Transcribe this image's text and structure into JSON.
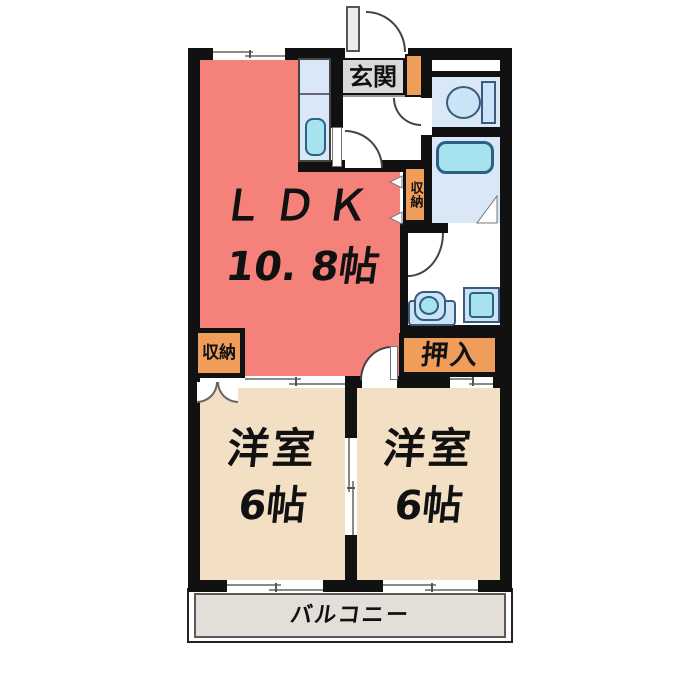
{
  "plan": {
    "ldk": {
      "label": "ＬＤＫ",
      "size": "10. 8帖"
    },
    "bedroom_left": {
      "label": "洋室",
      "size": "6帖"
    },
    "bedroom_right": {
      "label": "洋室",
      "size": "6帖"
    },
    "entrance_label": "玄関",
    "hall_storage_label": "収納",
    "ldk_storage_label": "収納",
    "oshiire_label": "押入",
    "balcony_label": "バルコニー"
  },
  "colors": {
    "ldk_fill": "#F5827A",
    "bedroom_fill": "#F3DFC3",
    "storage_fill": "#EE9D5B",
    "wet_area_fill": "#D9E7F7",
    "fixture_fill": "#C9E3F7",
    "fixture_accent": "#A6E3EF",
    "balcony_fill": "#E3DFD8",
    "entrance_label_fill": "#D9D9D9",
    "wall": "#111111"
  }
}
